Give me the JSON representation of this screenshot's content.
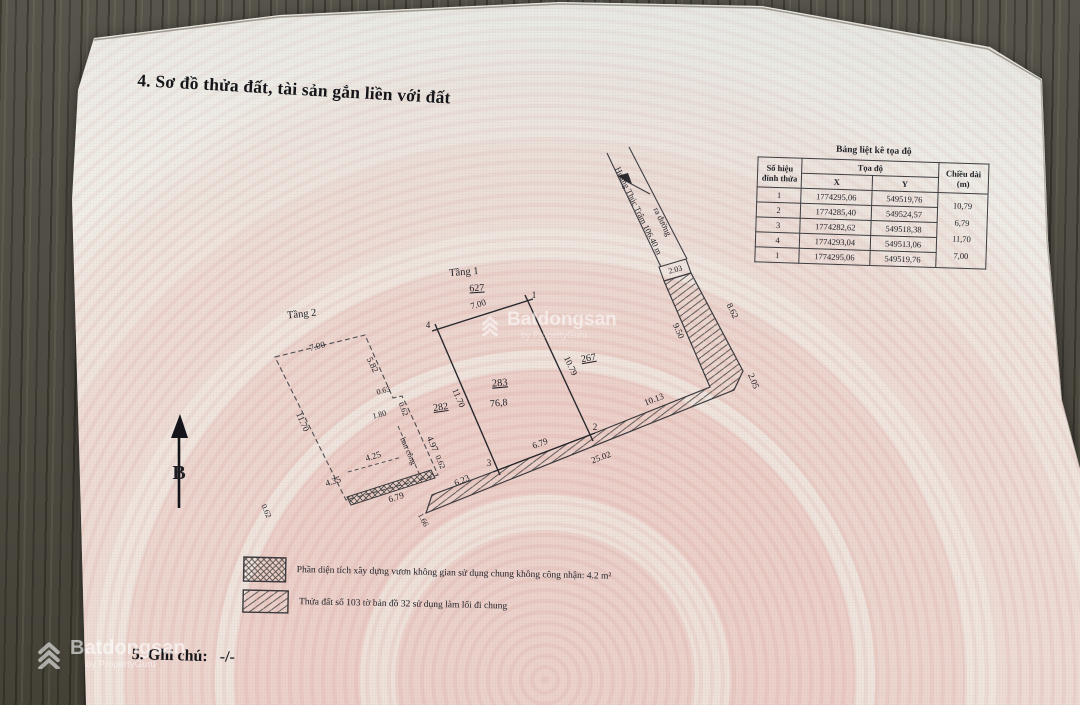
{
  "page": {
    "section4_title": "4. Sơ đồ thửa đất, tài sản gắn liền với đất",
    "section5_label": "5. Ghi chú:",
    "section5_value": "-/-"
  },
  "coord_table": {
    "caption": "Bảng liệt kê tọa độ",
    "col_vertex_line1": "Số hiệu",
    "col_vertex_line2": "đỉnh thửa",
    "col_coords": "Tọa độ",
    "col_x": "X",
    "col_y": "Y",
    "col_length_line1": "Chiều dài",
    "col_length_line2": "(m)",
    "rows": [
      {
        "id": "1",
        "x": "1774295,06",
        "y": "549519,76"
      },
      {
        "id": "2",
        "x": "1774285,40",
        "y": "549524,57"
      },
      {
        "id": "3",
        "x": "1774282,62",
        "y": "549518,38"
      },
      {
        "id": "4",
        "x": "1774293,04",
        "y": "549513,06"
      },
      {
        "id": "1",
        "x": "1774295,06",
        "y": "549519,76"
      }
    ],
    "lengths": [
      "10,79",
      "6,79",
      "11,70",
      "7,00"
    ]
  },
  "diagram": {
    "north": "B",
    "floor1": "Tầng 1",
    "floor2": "Tầng 2",
    "parcel": "283",
    "area": "76,8",
    "neighbor_top": "627",
    "neighbor_left": "282",
    "neighbor_right": "267",
    "balcony": "ban công",
    "road_label_1": "ra đường",
    "road_label_2": "Hoàng Thúc Trâm 106.40 m",
    "v1": "1",
    "v2": "2",
    "v3": "3",
    "v4": "4",
    "dims": {
      "plot_top": "7.00",
      "plot_left": "11.70",
      "plot_bottom": "6.79",
      "plot_right": "10.79",
      "neck": "2.03",
      "p_left": "9.50",
      "p_right": "8.62",
      "p_end": "2.05",
      "p_seg1": "10.13",
      "p_len": "25.02",
      "p_seg2": "6.23",
      "p_cap": "1.66",
      "f2_top": "7.00",
      "f2_left": "11.70",
      "f2_r1": "5.82",
      "f2_s1": "0.63",
      "f2_s2": "0.62",
      "f2_s3": "1.80",
      "f2_r2": "4.97",
      "f2_in": "4.25",
      "f2_strip": "4.35",
      "f2_strip_len": "6.79",
      "f2_cap_l": "0.62",
      "f2_cap_r": "0.62"
    }
  },
  "legend": {
    "item1": "Phần diện tích xây dựng vươn không gian sử dụng chung không công nhận: 4.2 m²",
    "item2": "Thửa đất số 103 tờ bản đồ 32 sử dụng làm lối đi chung"
  },
  "watermark": {
    "brand": "Batdongsan",
    "byline": "by PropertyGuru"
  }
}
